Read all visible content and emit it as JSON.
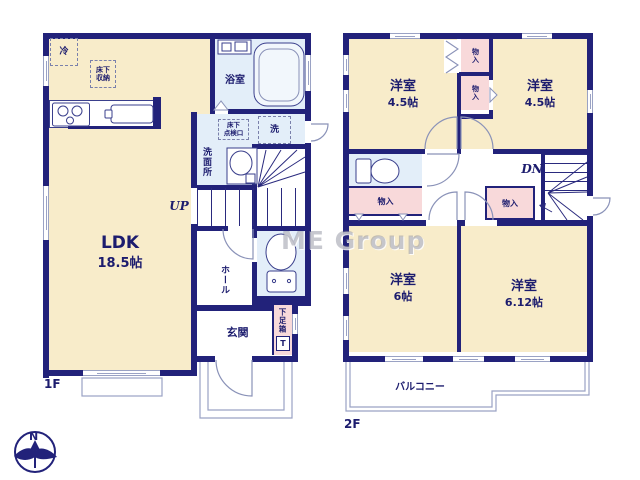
{
  "watermark": "ME Group",
  "compass": {
    "north": "N"
  },
  "floor1": {
    "label": "1F",
    "ldk_name": "LDK",
    "ldk_size": "18.5帖",
    "bath": "浴室",
    "washroom": "洗面所",
    "washer": "洗",
    "hatch": [
      "床下",
      "点検口"
    ],
    "storage": [
      "床下",
      "収納"
    ],
    "fridge": "冷",
    "stairs_up": "UP",
    "hall": "ホール",
    "entrance": "玄関",
    "shoe_box": "下足箱",
    "shoe_box_mark": "T"
  },
  "floor2": {
    "label": "2F",
    "rooms": [
      {
        "name": "洋室",
        "size": "4.5帖"
      },
      {
        "name": "洋室",
        "size": "4.5帖"
      },
      {
        "name": "洋室",
        "size": "6帖"
      },
      {
        "name": "洋室",
        "size": "6.12帖"
      }
    ],
    "closets": [
      "物入",
      "物入",
      "物入",
      "物入"
    ],
    "stairs_down": "DN",
    "balcony": "バルコニー"
  }
}
